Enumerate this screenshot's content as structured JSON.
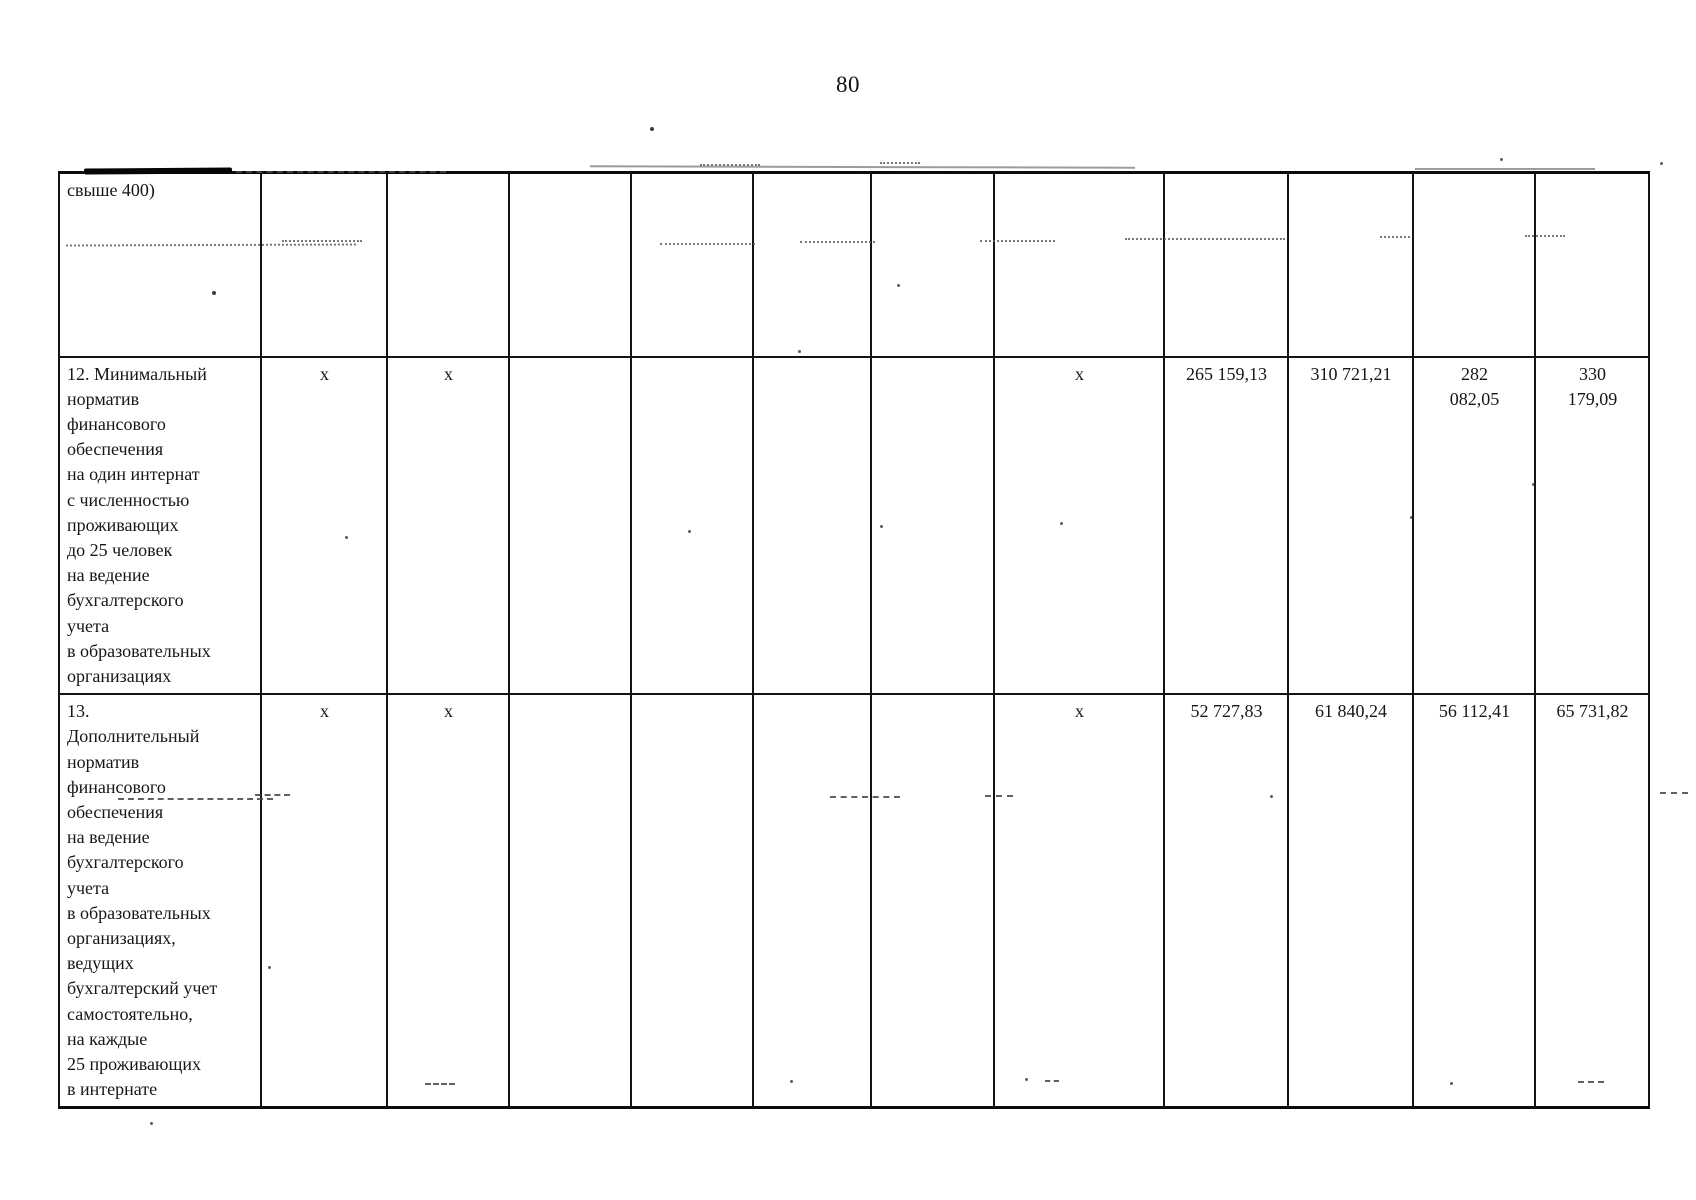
{
  "page": {
    "number": "80"
  },
  "table": {
    "rows": [
      {
        "cells": [
          "свыше 400)",
          "",
          "",
          "",
          "",
          "",
          "",
          "",
          "",
          "",
          "",
          ""
        ]
      },
      {
        "cells": [
          "12. Минимальный\nнорматив\nфинансового\nобеспечения\nна один интернат\nс численностью\nпроживающих\nдо 25 человек\nна ведение\nбухгалтерского\nучета\nв образовательных\nорганизациях",
          "х",
          "х",
          "",
          "",
          "",
          "",
          "х",
          "265 159,13",
          "310 721,21",
          "282\n082,05",
          "330\n179,09"
        ]
      },
      {
        "cells": [
          "13.\nДополнительный\nнорматив\nфинансового\nобеспечения\nна ведение\nбухгалтерского\nучета\nв образовательных\nорганизациях,\nведущих\nбухгалтерский учет\nсамостоятельно,\nна каждые\n25 проживающих\nв интернате",
          "х",
          "х",
          "",
          "",
          "",
          "",
          "х",
          "52 727,83",
          "61 840,24",
          "56 112,41",
          "65 731,82"
        ]
      }
    ]
  }
}
